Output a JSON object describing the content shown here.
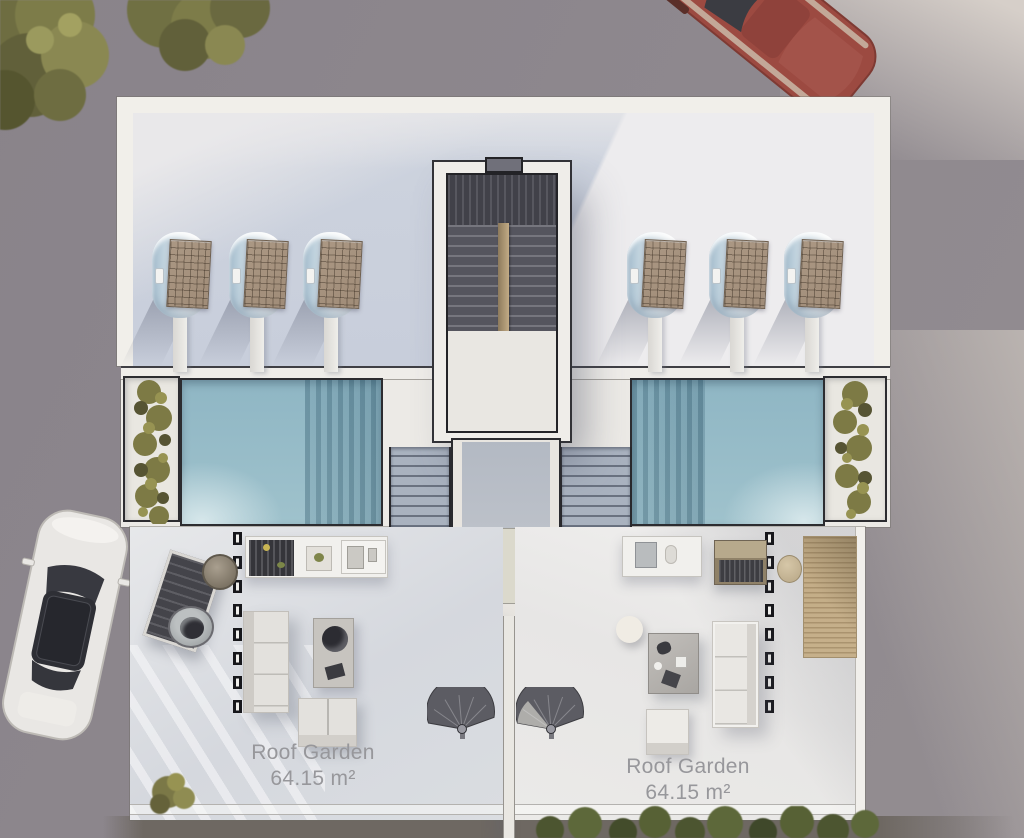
{
  "plan": {
    "floor_name": "Roof floor plan",
    "units": [
      {
        "id": "left",
        "garden_label": "Roof Garden",
        "garden_area": "64.15 m²"
      },
      {
        "id": "right",
        "garden_label": "Roof Garden",
        "garden_area": "64.15 m²"
      }
    ]
  },
  "colors": {
    "ground": "#8c868c",
    "wall-white": "#f1efea",
    "roof-shade": "#cdd3de",
    "roof-light": "#edecee",
    "pool-water": "#8fb6c4",
    "terrace-right": "#ebeae8",
    "stair-dark": "#55555e",
    "wood": "#c2ab85",
    "solar-panel": "#a08c78",
    "plant-olive": "#73713f",
    "label-text": "#97979b",
    "car-red": "#9c4a41",
    "car-white": "#e9e7e4"
  }
}
